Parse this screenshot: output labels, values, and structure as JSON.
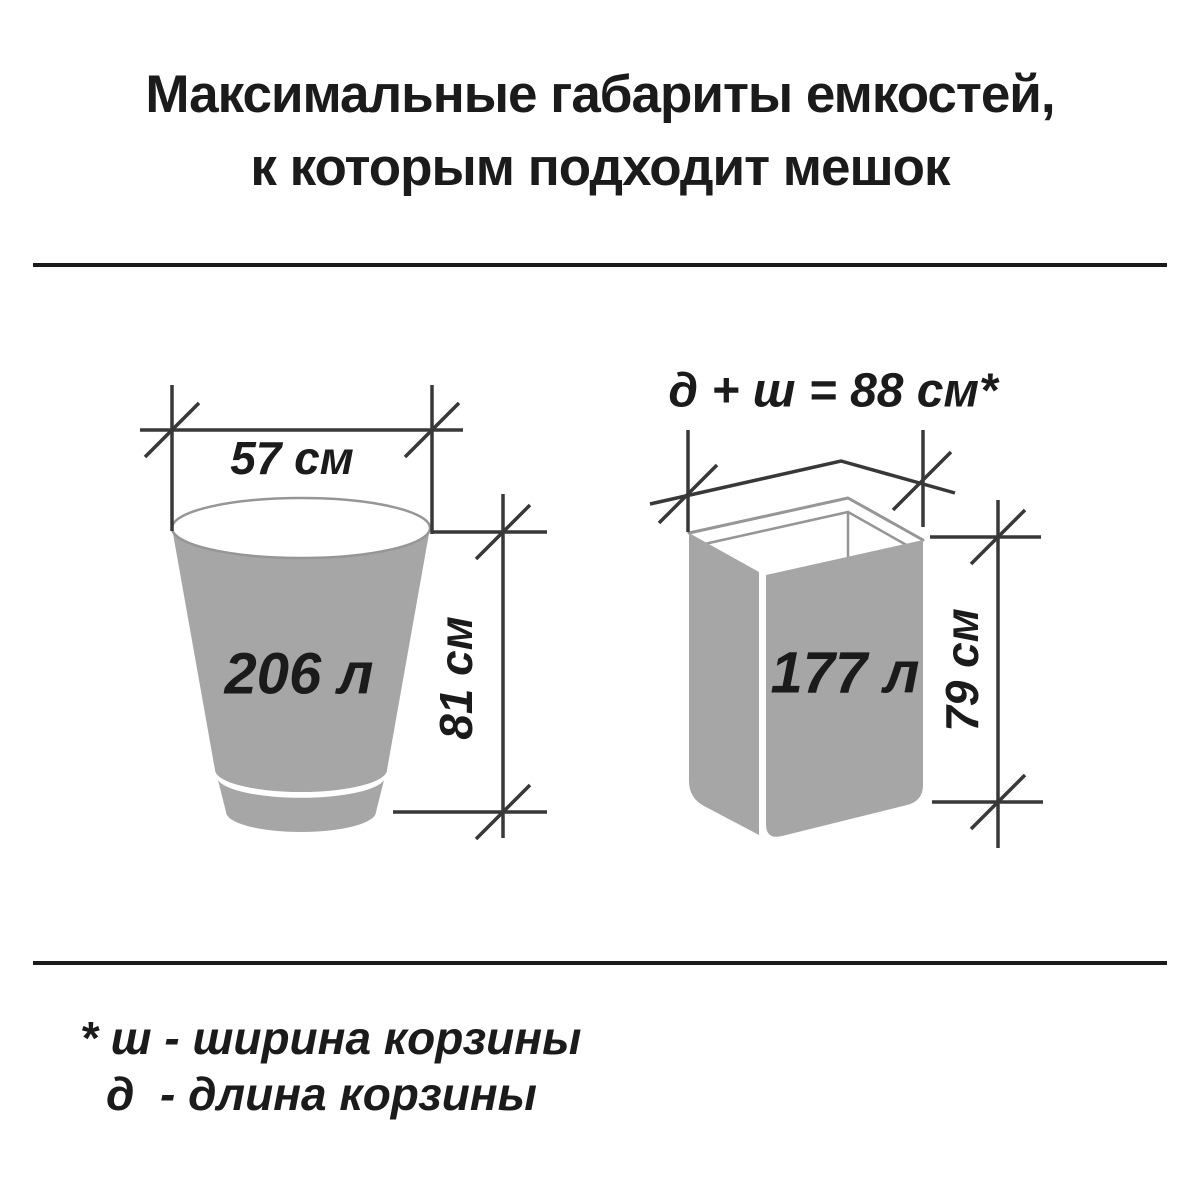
{
  "title": {
    "line1": "Максимальные габариты емкостей,",
    "line2": "к которым подходит мешок"
  },
  "left_diagram": {
    "shape": "round tapered bucket",
    "width_label": "57 см",
    "volume_label": "206 л",
    "height_label": "81 см"
  },
  "right_diagram": {
    "shape": "rectangular basket",
    "dimension_formula": "д + ш = 88 см*",
    "volume_label": "177 л",
    "height_label": "79 см"
  },
  "footnote": {
    "line1": "* ш - ширина корзины",
    "line2": "д  - длина корзины"
  },
  "colors": {
    "container_gray": "#a6a6a6",
    "rim_gray": "#969696",
    "dimension_line": "#383838",
    "text": "#1b1b1b"
  }
}
